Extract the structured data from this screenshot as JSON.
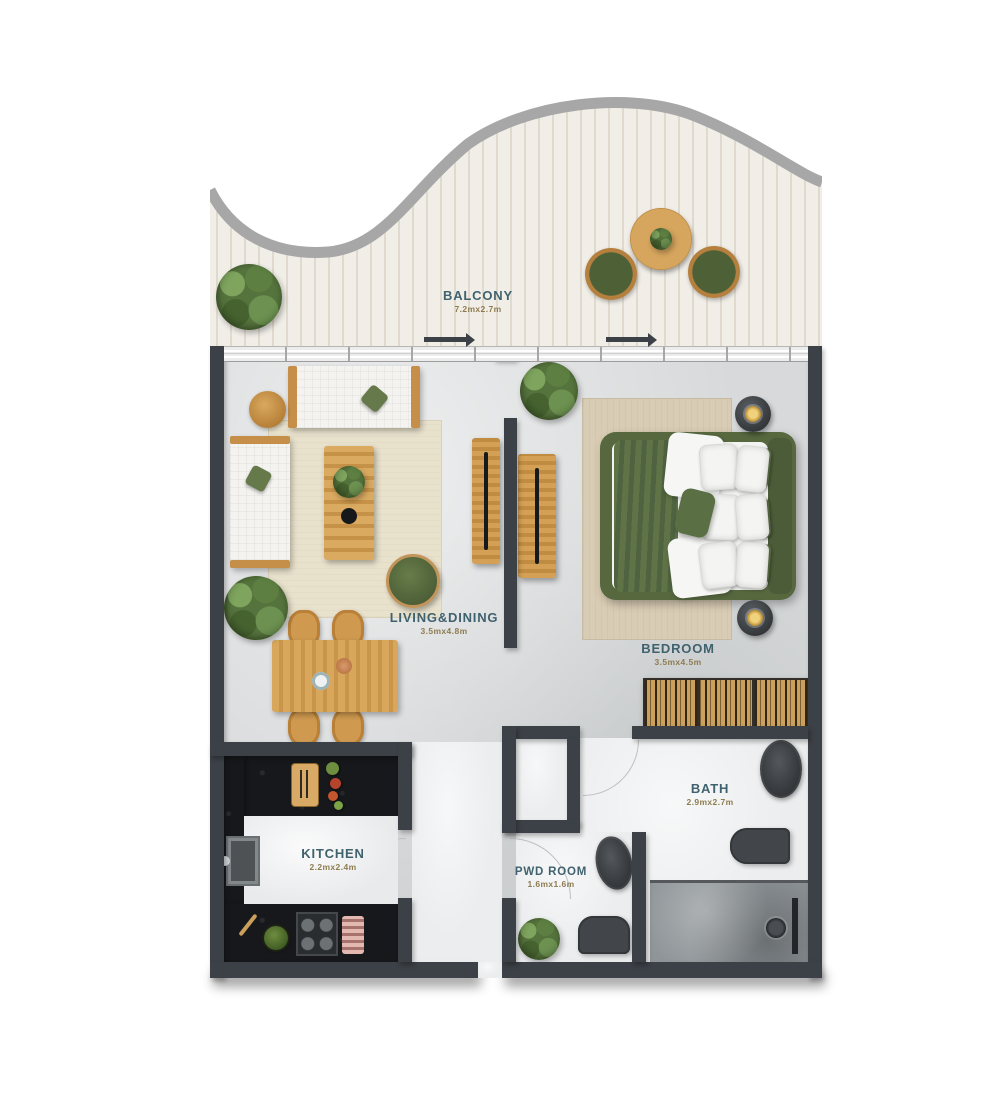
{
  "rooms": {
    "balcony": {
      "label": "BALCONY",
      "dims": "7.2mx2.7m"
    },
    "living": {
      "label": "LIVING&DINING",
      "dims": "3.5mx4.8m"
    },
    "bedroom": {
      "label": "BEDROOM",
      "dims": "3.5mx4.5m"
    },
    "bath": {
      "label": "BATH",
      "dims": "2.9mx2.7m"
    },
    "pwd": {
      "label": "PWD ROOM",
      "dims": "1.6mx1.6m"
    },
    "kitchen": {
      "label": "KITCHEN",
      "dims": "2.2mx2.4m"
    }
  },
  "colors": {
    "wall": "#3c4147",
    "room_label": "#40626e",
    "room_dims": "#8e7c50",
    "accent_green": "#5a6b41",
    "wood": "#cf9a52",
    "deck": "#f1eee8",
    "railing": "#a7a7a7"
  }
}
